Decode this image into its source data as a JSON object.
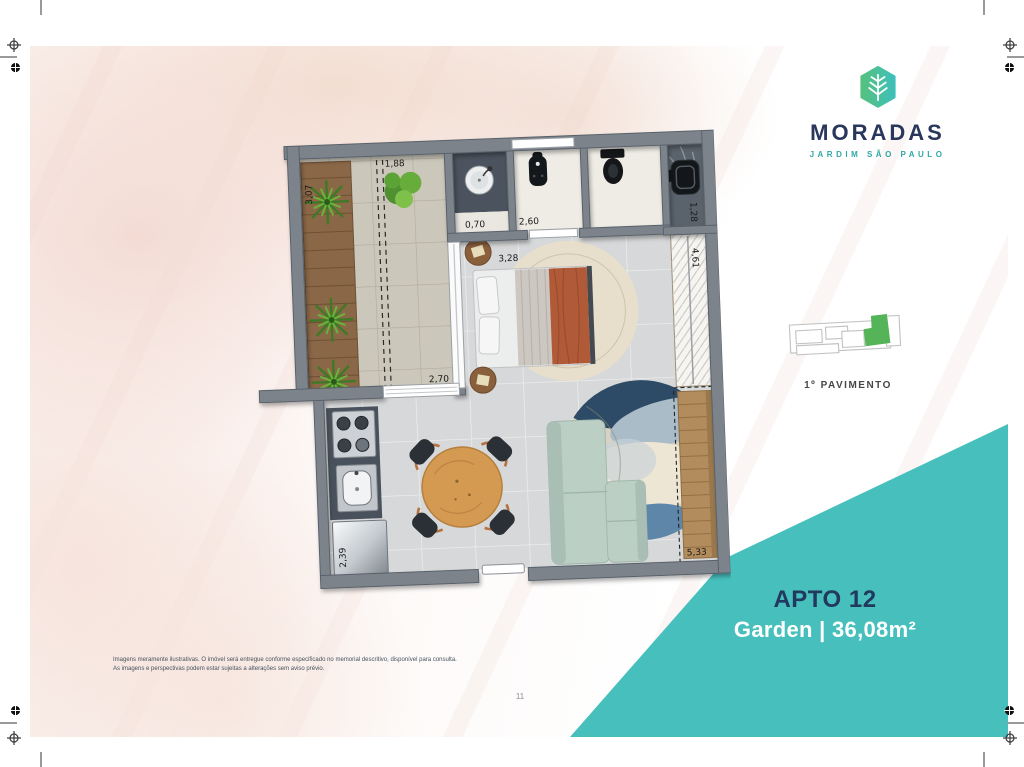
{
  "brand": {
    "name": "MORADAS",
    "subtitle": "JARDIM SÃO PAULO"
  },
  "unit": {
    "title": "APTO 12",
    "area_line": "Garden | 36,08m²",
    "floor_label": "1º PAVIMENTO"
  },
  "floor_plan": {
    "dimensions": {
      "terrace_width_top": "1,88",
      "planter_length": "3,07",
      "terrace_width_bottom": "2,70",
      "washbasin_nook": "0,70",
      "bathroom_length": "2,60",
      "bedroom_width": "3,28",
      "service_width": "1,28",
      "closet_length": "4,61",
      "kitchen_counter": "2,39",
      "living_length": "5,33"
    }
  },
  "footer": {
    "disclaimer_line1": "Imagens meramente ilustrativas. O imóvel será entregue conforme especificado no memorial descritivo, disponível para consulta.",
    "disclaimer_line2": "As imagens e perspectivas podem estar sujeitas a alterações sem aviso prévio.",
    "page_number": "11"
  },
  "colors": {
    "accent_teal": "#47c0bd",
    "brand_navy": "#28375b",
    "brand_teal": "#2fa7a5",
    "keyplan_unit_green": "#55b457"
  }
}
